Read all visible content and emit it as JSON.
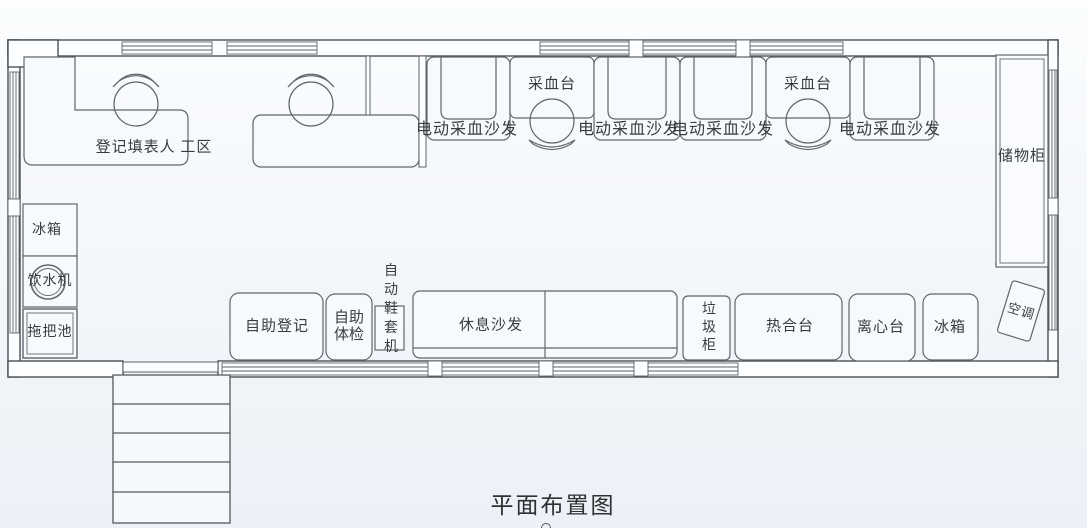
{
  "diagram": {
    "title": "平面布置图",
    "labels": {
      "registration_area": "登记填表人 工区",
      "blood_collection_table": "采血台",
      "electric_blood_collection_sofa": "电动采血沙发",
      "storage_cabinet": "储物柜",
      "refrigerator": "冰箱",
      "water_dispenser": "饮水机",
      "mop_sink": "拖把池",
      "self_registration": "自助登记",
      "self_health_check": "自助体检",
      "auto_shoe_cover_machine": "自动鞋套机",
      "rest_sofa": "休息沙发",
      "garbage_cabinet": "垃圾柜",
      "heat_sealing_station": "热合台",
      "centrifuge_station": "离心台",
      "air_conditioner": "空调"
    },
    "colors": {
      "wall_line": "#4b4f54",
      "furniture_line": "#61666c",
      "text": "#393c40",
      "background_top": "#fbfdfe",
      "background_bottom": "#ecf1f7"
    }
  }
}
